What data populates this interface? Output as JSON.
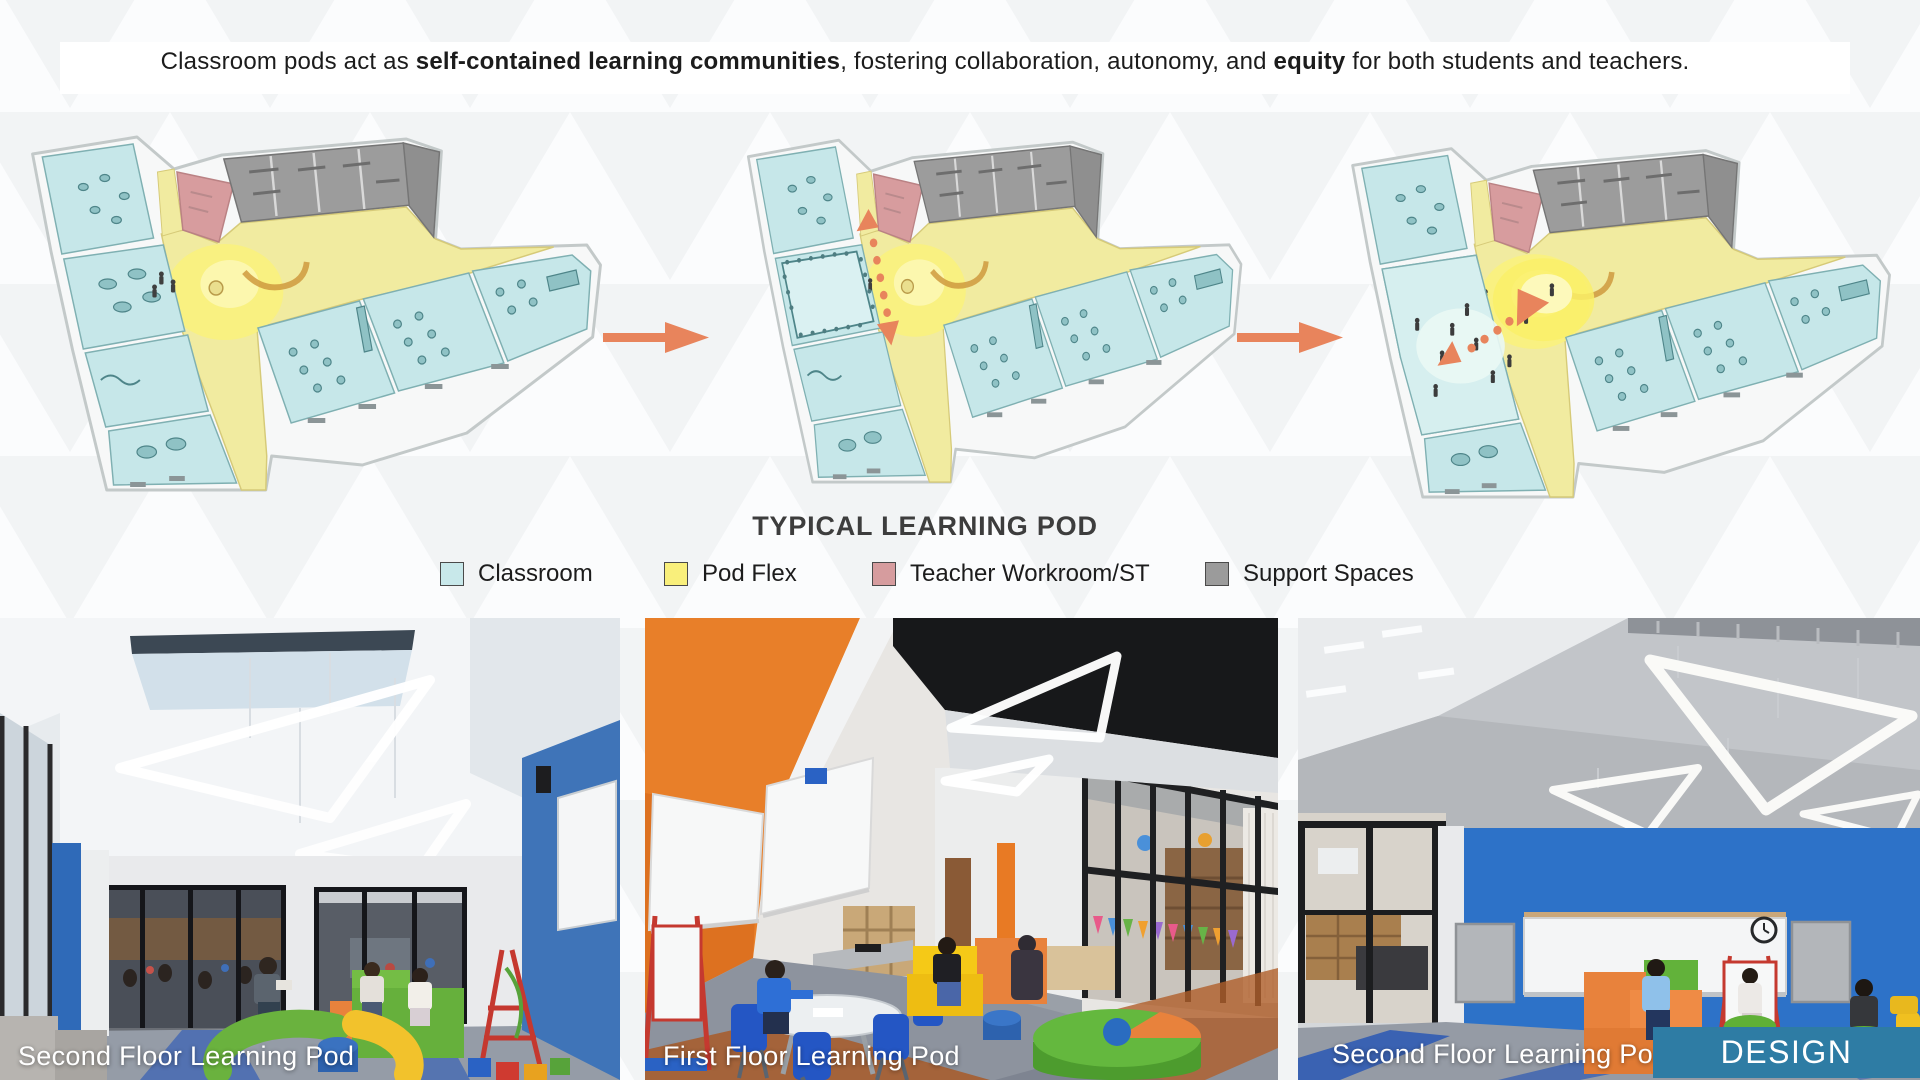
{
  "slide": {
    "header": {
      "prefix": "Classroom pods act as ",
      "bold1": "self-contained learning communities",
      "middle": ", fostering collaboration, autonomy, and ",
      "bold2": "equity",
      "suffix": " for both students and teachers."
    },
    "diagram": {
      "title": "TYPICAL LEARNING POD",
      "legend": [
        {
          "label": "Classroom",
          "color": "#c8e8ea"
        },
        {
          "label": "Pod Flex",
          "color": "#f9ef7b"
        },
        {
          "label": "Teacher Workroom/ST",
          "color": "#d69c9e"
        },
        {
          "label": "Support Spaces",
          "color": "#9b9b9b"
        }
      ],
      "flow_arrow_color": "#e8845c"
    },
    "photos": [
      {
        "caption": "Second Floor Learning Pod"
      },
      {
        "caption": "First Floor Learning Pod"
      },
      {
        "caption": "Second Floor Learning Pod"
      }
    ],
    "badge": {
      "label": "DESIGN",
      "color": "#2e7ca4"
    }
  }
}
